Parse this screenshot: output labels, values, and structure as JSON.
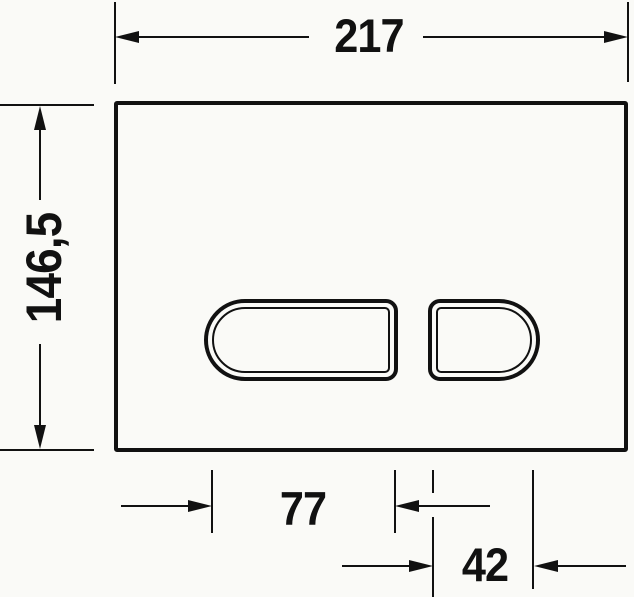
{
  "drawing": {
    "name": "flush-plate-dimension-drawing",
    "background_color": "#fafaf7",
    "line_color": "#111111",
    "labels": {
      "overall_width": "217",
      "overall_height": "146,5",
      "large_button_width": "77",
      "small_button_width": "42"
    }
  }
}
